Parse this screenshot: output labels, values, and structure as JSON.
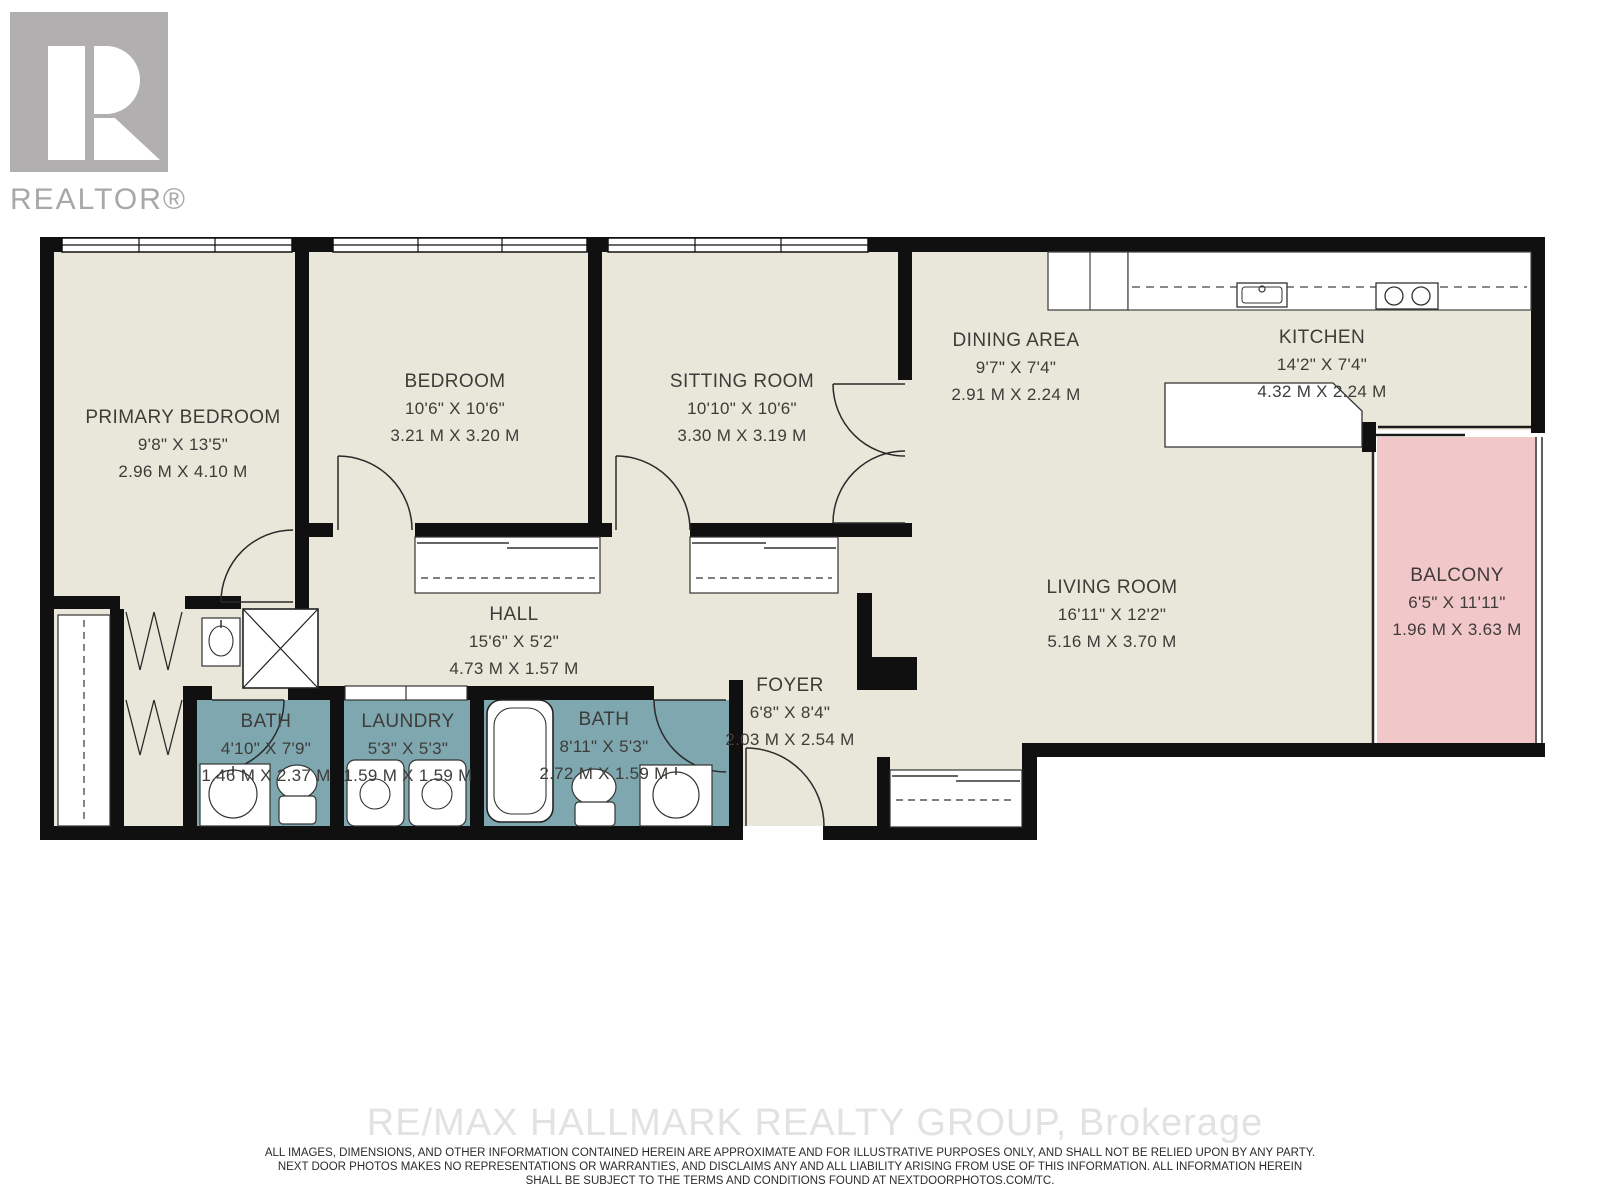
{
  "logo": {
    "brand_text": "REALTOR®"
  },
  "plan": {
    "rooms": [
      {
        "id": "primary-bedroom",
        "name": "PRIMARY BEDROOM",
        "imperial": "9'8\" X 13'5\"",
        "metric": "2.96 M X 4.10 M"
      },
      {
        "id": "bedroom",
        "name": "BEDROOM",
        "imperial": "10'6\" X 10'6\"",
        "metric": "3.21 M X 3.20 M"
      },
      {
        "id": "sitting-room",
        "name": "SITTING ROOM",
        "imperial": "10'10\" X 10'6\"",
        "metric": "3.30 M X 3.19 M"
      },
      {
        "id": "dining-area",
        "name": "DINING AREA",
        "imperial": "9'7\" X 7'4\"",
        "metric": "2.91 M X 2.24 M"
      },
      {
        "id": "kitchen",
        "name": "KITCHEN",
        "imperial": "14'2\" X 7'4\"",
        "metric": "4.32 M X 2.24 M"
      },
      {
        "id": "living-room",
        "name": "LIVING ROOM",
        "imperial": "16'11\" X 12'2\"",
        "metric": "5.16 M X 3.70 M"
      },
      {
        "id": "balcony",
        "name": "BALCONY",
        "imperial": "6'5\" X 11'11\"",
        "metric": "1.96 M X 3.63 M"
      },
      {
        "id": "hall",
        "name": "HALL",
        "imperial": "15'6\" X 5'2\"",
        "metric": "4.73 M X 1.57 M"
      },
      {
        "id": "foyer",
        "name": "FOYER",
        "imperial": "6'8\" X 8'4\"",
        "metric": "2.03 M X 2.54 M"
      },
      {
        "id": "bath-1",
        "name": "BATH",
        "imperial": "4'10\" X 7'9\"",
        "metric": "1.46 M X 2.37 M"
      },
      {
        "id": "laundry",
        "name": "LAUNDRY",
        "imperial": "5'3\" X 5'3\"",
        "metric": "1.59 M X 1.59 M"
      },
      {
        "id": "bath-2",
        "name": "BATH",
        "imperial": "8'11\" X 5'3\"",
        "metric": "2.72 M X 1.59 M"
      }
    ]
  },
  "watermark": "RE/MAX HALLMARK REALTY GROUP, Brokerage",
  "disclaimer": [
    "ALL IMAGES, DIMENSIONS, AND OTHER INFORMATION CONTAINED HEREIN ARE APPROXIMATE AND FOR ILLUSTRATIVE PURPOSES ONLY, AND SHALL NOT BE RELIED UPON BY ANY PARTY.",
    "NEXT DOOR PHOTOS MAKES NO REPRESENTATIONS OR WARRANTIES, AND DISCLAIMS ANY AND ALL LIABILITY ARISING FROM USE OF THIS INFORMATION. ALL INFORMATION HEREIN",
    "SHALL BE SUBJECT TO THE TERMS AND CONDITIONS FOUND AT NEXTDOORPHOTOS.COM/TC."
  ],
  "colors": {
    "floor": "#e9e6da",
    "wall": "#101010",
    "bath_teal": "#7ea7b0",
    "balcony_pink": "#f1c7ca",
    "label_text": "#3e3c38",
    "logo_gray": "#b1afaf",
    "watermark_gray": "#e2e2e2"
  }
}
